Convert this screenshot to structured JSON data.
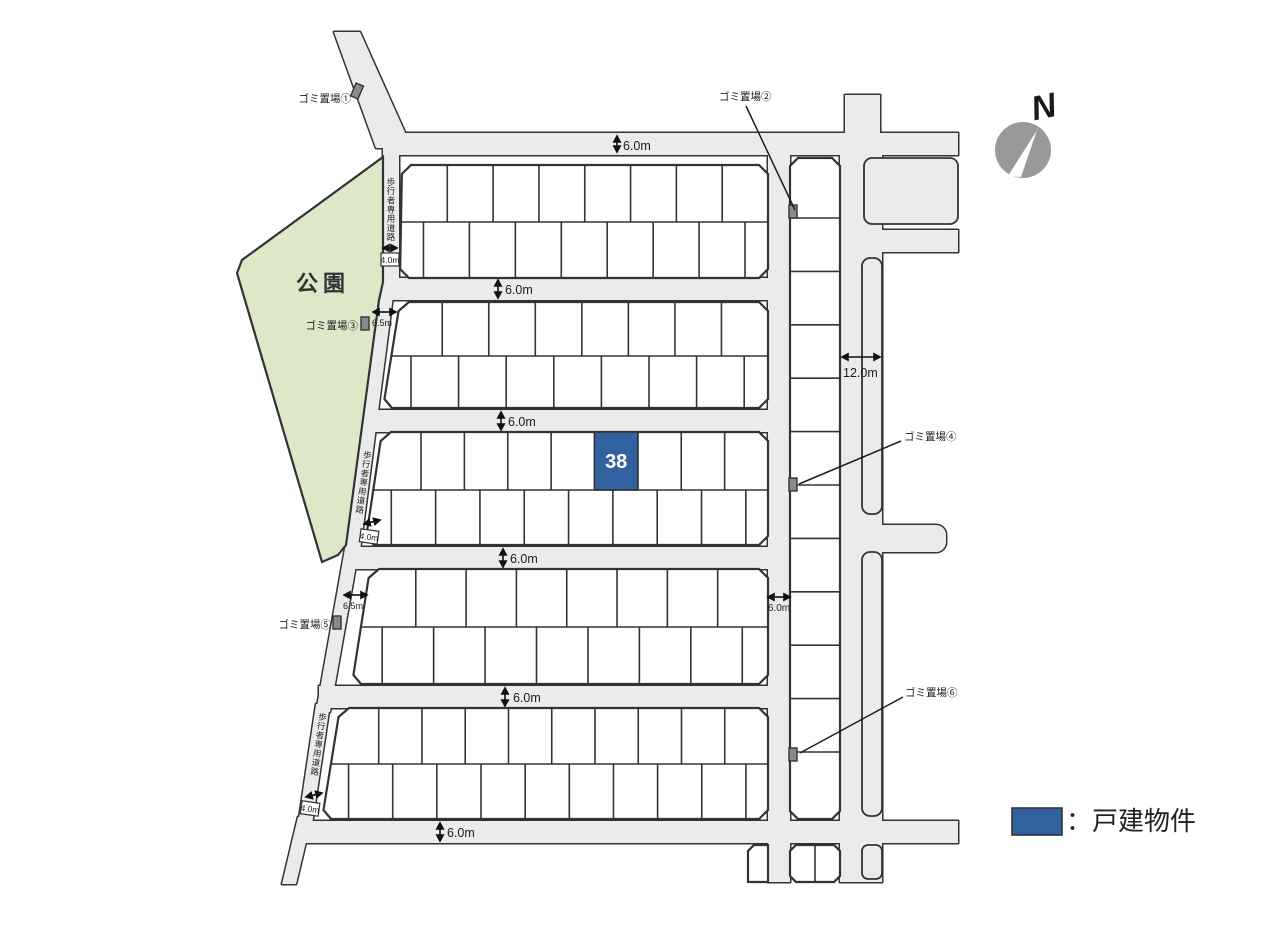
{
  "colors": {
    "road_fill": "#ebebeb",
    "outline": "#333333",
    "park_fill": "#dce8c7",
    "featured_lot_fill": "#31629f",
    "garbage_icon_fill": "#8a8a8a",
    "compass_fill": "#999999",
    "lot_fill": "#ffffff"
  },
  "map": {
    "park_label": "公園",
    "compass_label": "N",
    "pedestrian_road_label": "歩行者専用道路",
    "featured_lot_number": "38",
    "garbage_stations": {
      "g1": "ゴミ置場①",
      "g2": "ゴミ置場②",
      "g3": "ゴミ置場③",
      "g4": "ゴミ置場④",
      "g5": "ゴミ置場⑤",
      "g6": "ゴミ置場⑥"
    },
    "dimensions": {
      "road_6m": "6.0m",
      "road_12m": "12.0m",
      "road_6_5m": "6.5m",
      "road_4m": "4.0m"
    },
    "legend": {
      "label": "：戸建物件"
    }
  }
}
